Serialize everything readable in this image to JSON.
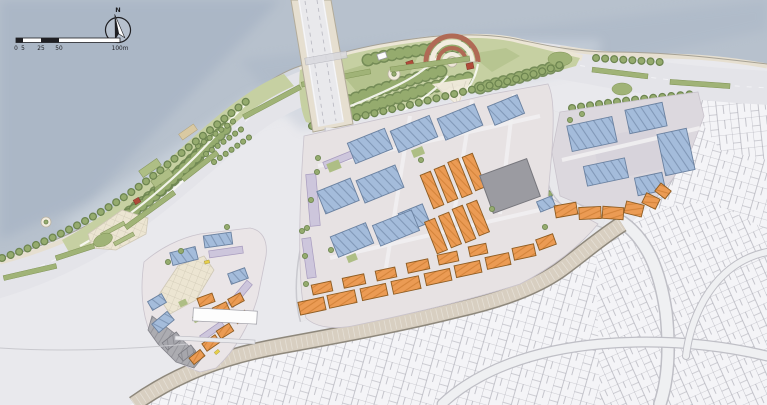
{
  "plan": {
    "compass": {
      "label": "N"
    },
    "scale_bar": {
      "labels": [
        "0",
        "5",
        "25",
        "50",
        "100m"
      ]
    },
    "colors": {
      "water": "#b7c1cd",
      "water_deep": "#9dabbf",
      "water_light": "#d4dbe3",
      "land": "#e9e9ed",
      "fabric_bg": "#f4f4f7",
      "fabric_line": "#a6a6b0",
      "road": "#e4e4e9",
      "road_casing": "#c8c8cf",
      "street_tan": "#d8cfc1",
      "street_edge": "#8e887c",
      "bridge_deck": "#e6dfd0",
      "park_base": "#c6d0a2",
      "lawn": "#aebe85",
      "tree": "#95ab6e",
      "tree_dark": "#6d8550",
      "median": "#a0b377",
      "plaza_cream": "#ece5d2",
      "orange": "#eb9b54",
      "orange_line": "#8e5c22",
      "blue": "#a4bcdb",
      "blue_line": "#6a81a0",
      "lavender": "#cdc6dc",
      "lavender_line": "#a89cbf",
      "gray_roof": "#a6a6ac",
      "gray_line": "#7c7c83",
      "red": "#b04a39",
      "amphi": "#b06a55",
      "cream_white": "#f2ecdf",
      "path_white": "#fbfbf5",
      "ink": "#1f1f23",
      "ground_left": "#eae5e7",
      "ground_center": "#e7e2e3",
      "ground_right": "#dcd8de",
      "courtyard_gray": "#d7d3db"
    }
  }
}
